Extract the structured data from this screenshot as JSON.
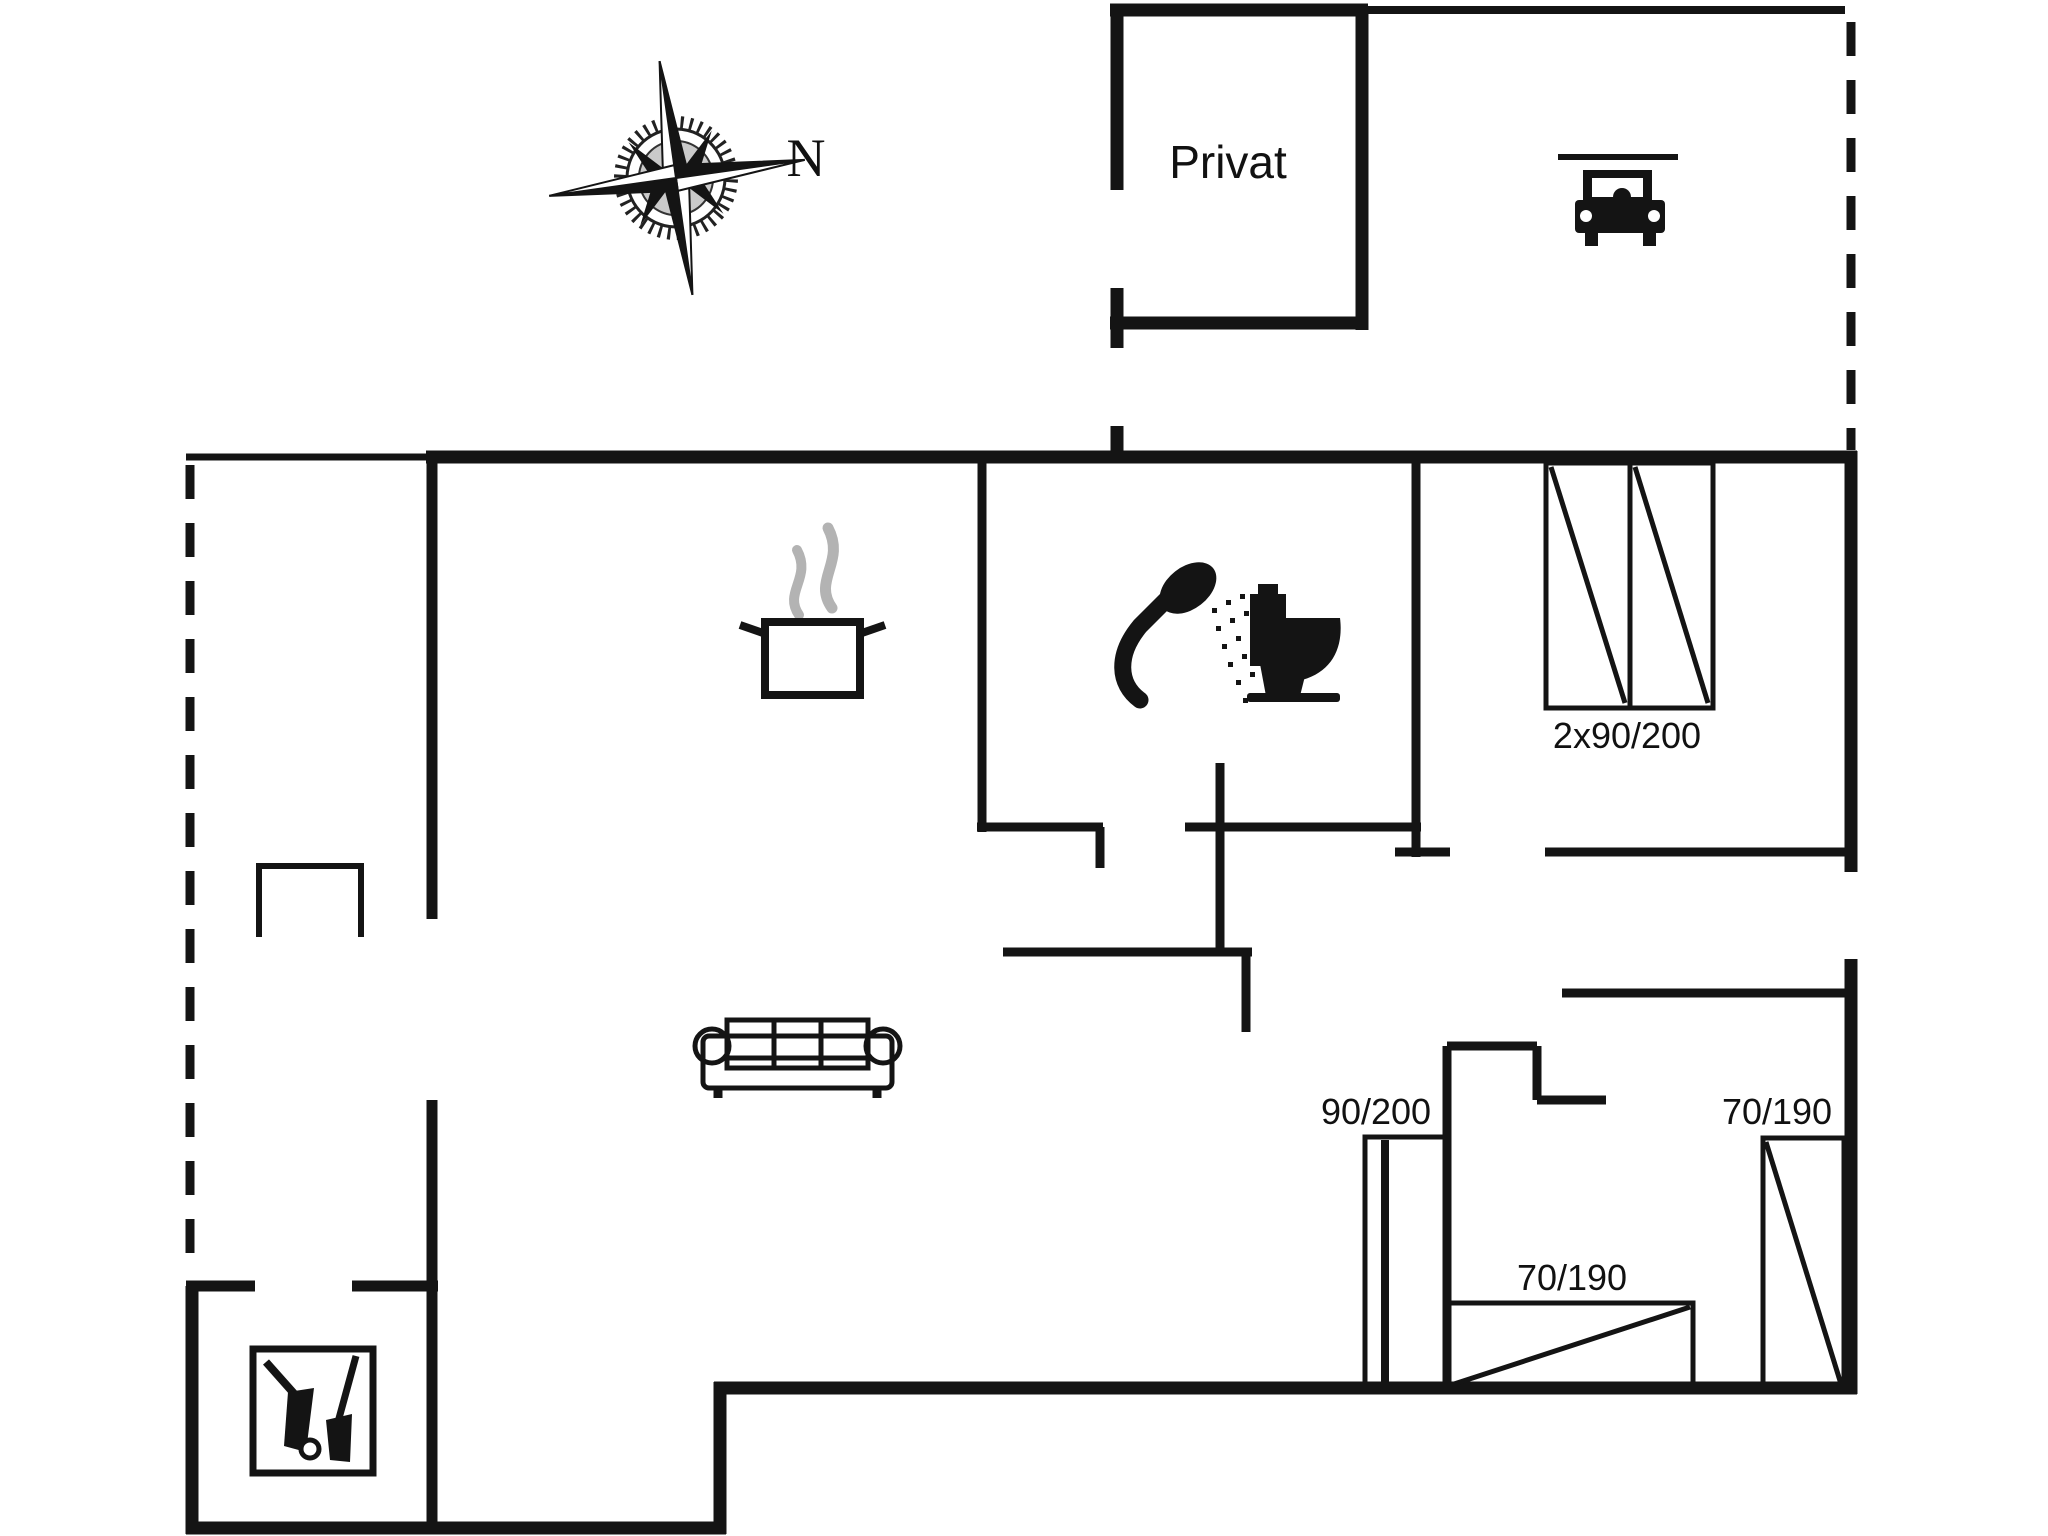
{
  "page": {
    "type": "floor-plan",
    "background": "#ffffff"
  },
  "colors": {
    "wall": "#141414",
    "steam": "#b3b3b3",
    "white": "#ffffff"
  },
  "labels": {
    "annex_room": "Privat",
    "compass_north": "N",
    "bedroom_double_beds": "2x90/200",
    "bed_hall": "90/200",
    "bed_middle": "70/190",
    "bed_right": "70/190"
  },
  "icons": {
    "compass": "compass-rose",
    "car": "car-front-carport",
    "pot": "cooking-pot-with-steam",
    "shower": "hand-shower-spray",
    "toilet": "toilet-side-view",
    "sofa": "three-seat-sofa",
    "stove": "wood-stove-with-fire-tools",
    "beds": "bed-rectangle-with-diagonal"
  }
}
